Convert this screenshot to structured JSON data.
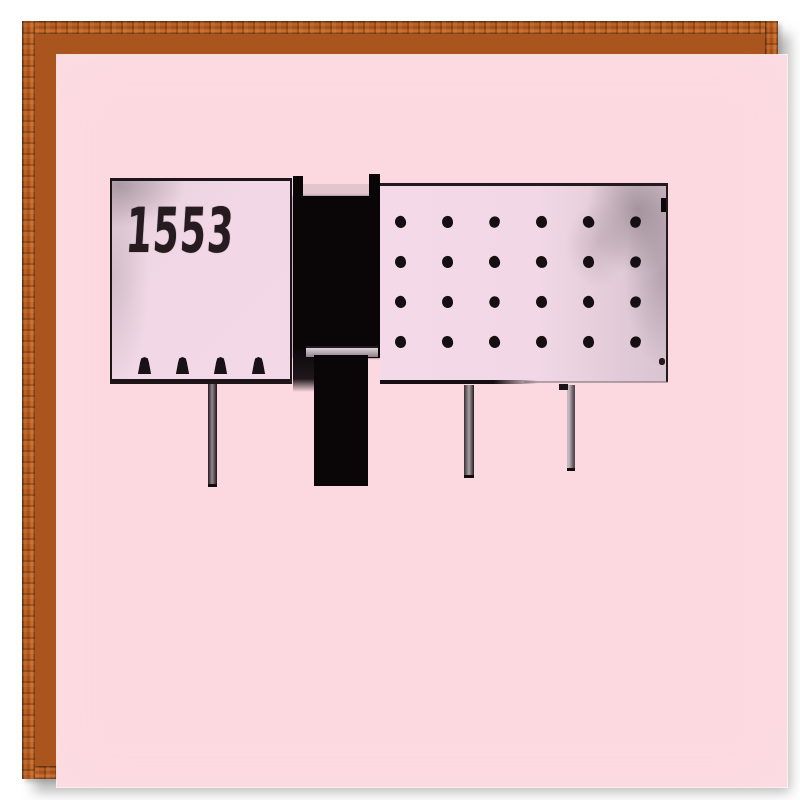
{
  "scene": {
    "description": "Framed pink-toned photograph of a modernist building with a dark central tower",
    "frame_material": "wood"
  },
  "artwork": {
    "label": "1553",
    "window_dots": {
      "rows": 4,
      "cols": 6
    },
    "knobs": {
      "count": 4
    },
    "legs": {
      "count": 3
    },
    "colors": {
      "frame_wood": "#a9551d",
      "mat_pink": "#fcd9e0",
      "panel_pink": "#f2d8e6",
      "ink_black": "#0a0608",
      "shade_gray": "#c7bbc3"
    }
  }
}
